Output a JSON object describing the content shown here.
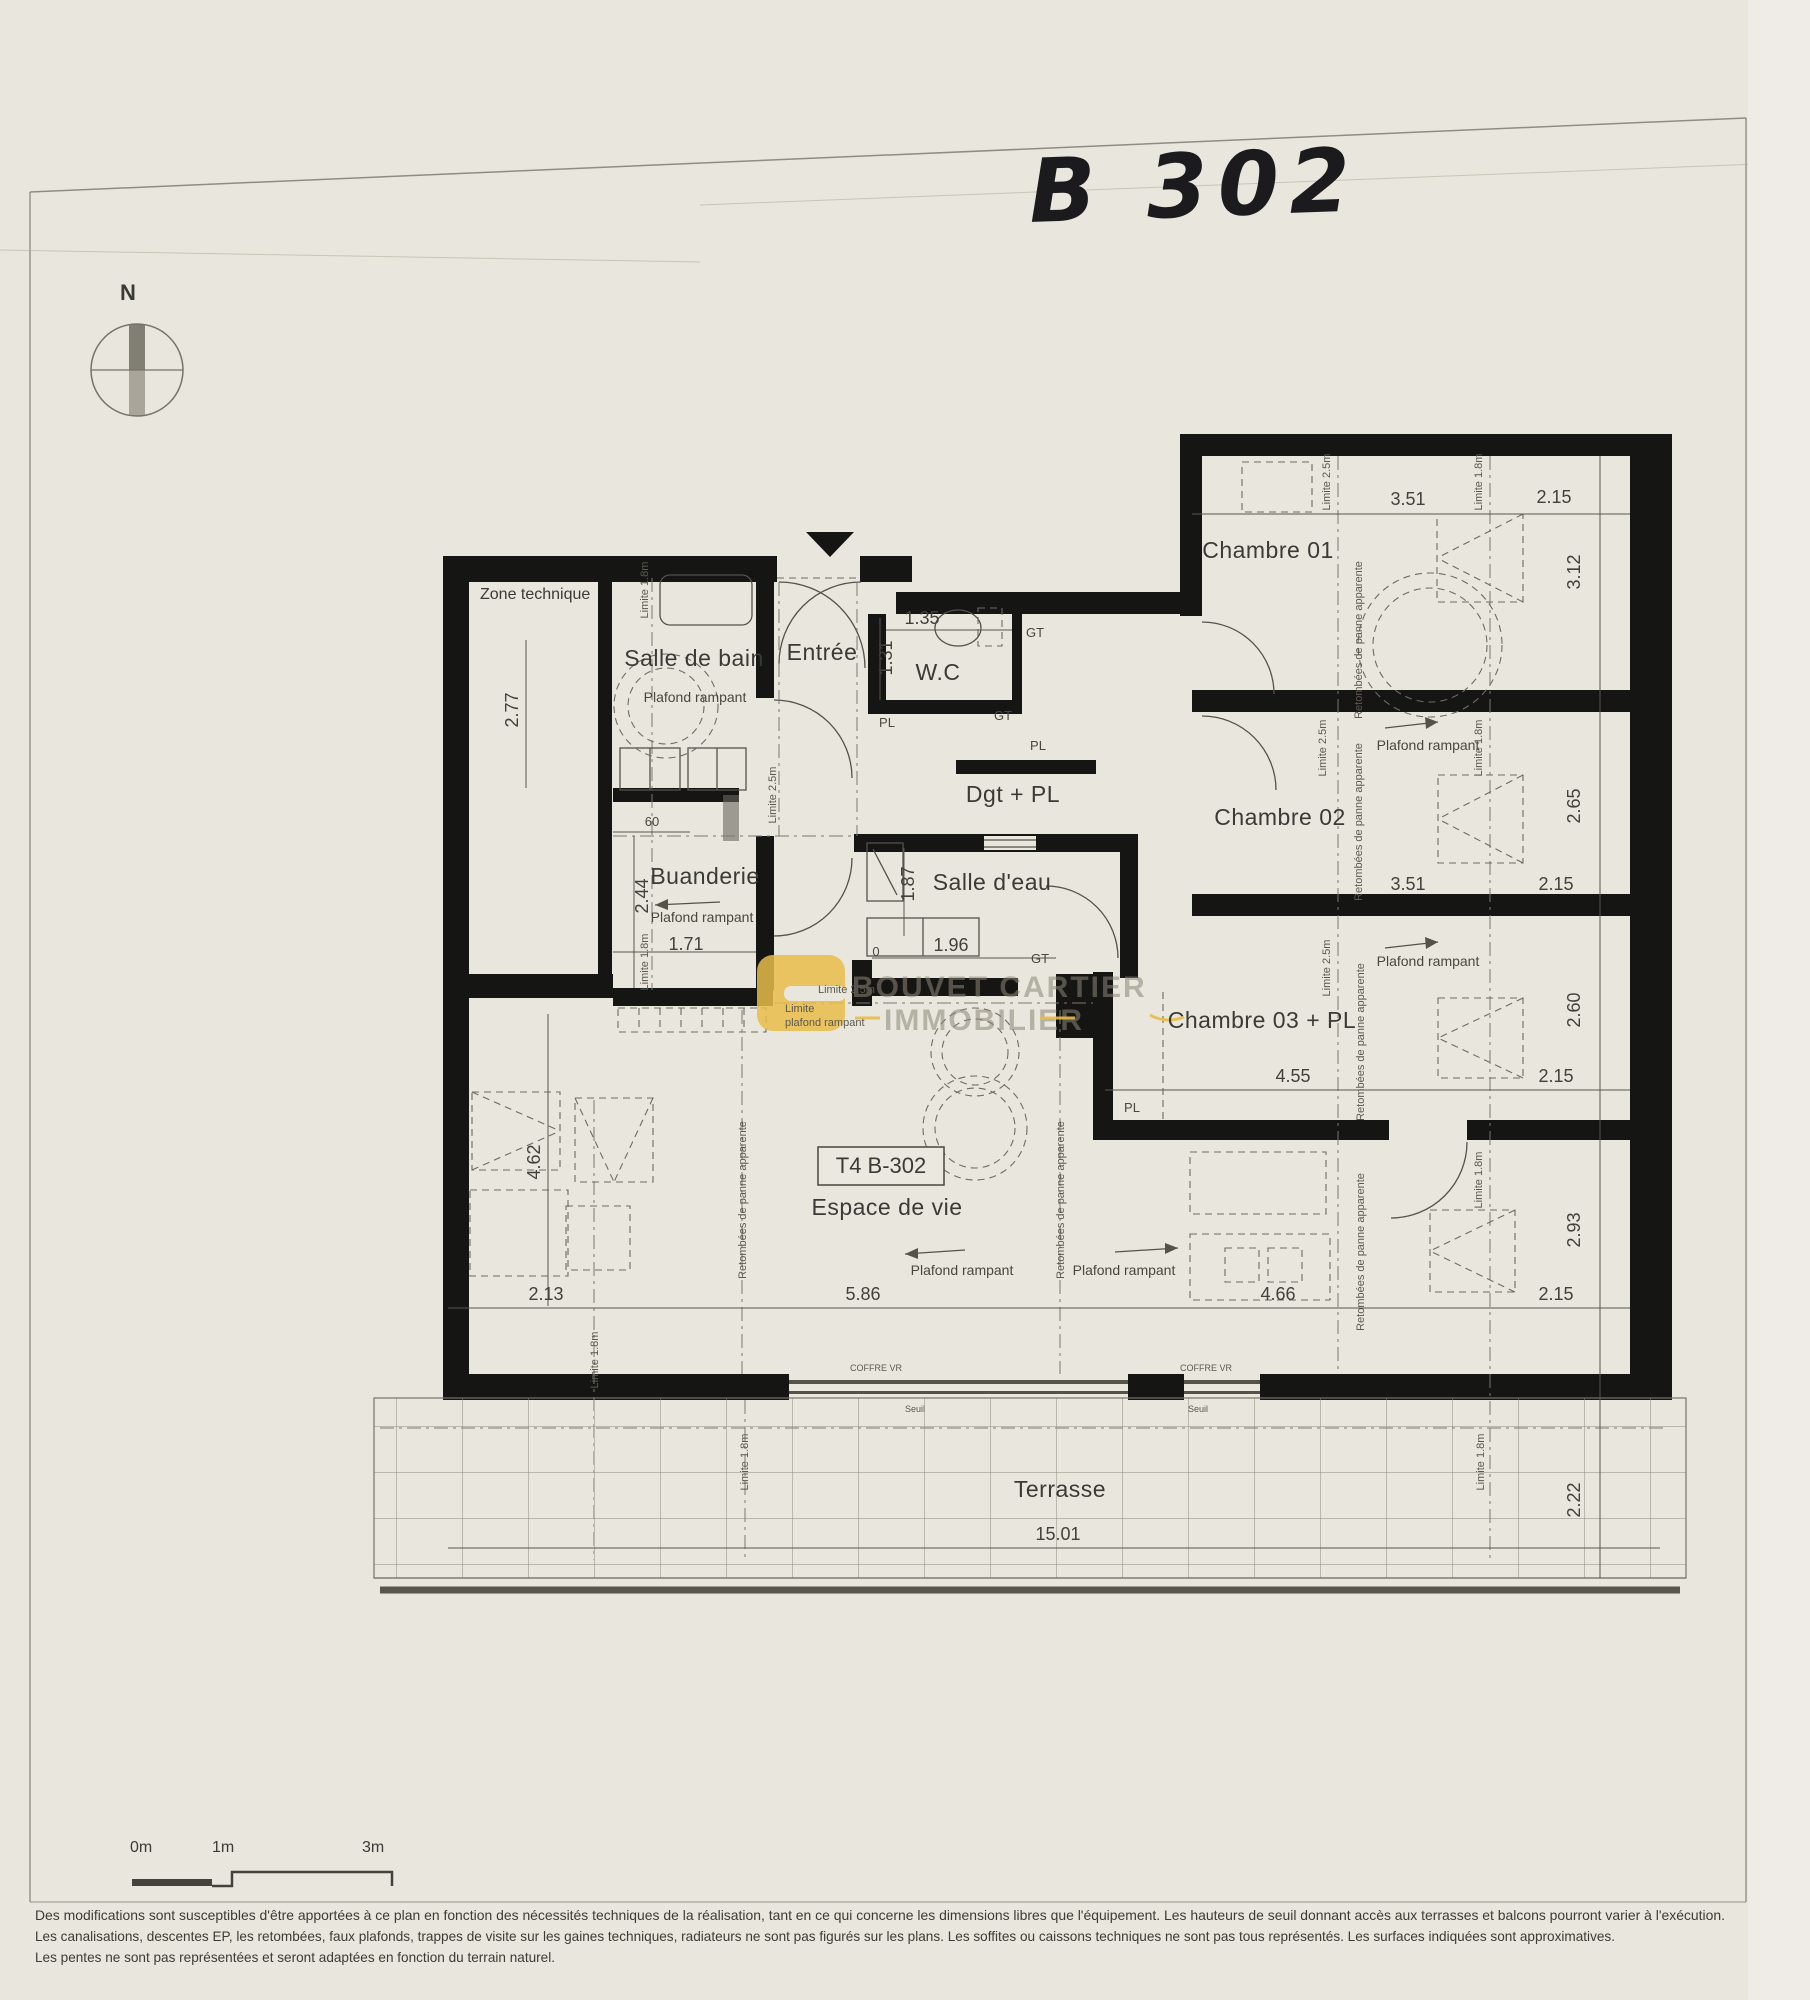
{
  "page": {
    "title_handwritten": "B 302",
    "compass_n": "N"
  },
  "rooms": {
    "zone_technique": "Zone technique",
    "salle_de_bain": "Salle de bain",
    "entree": "Entrée",
    "wc": "W.C",
    "dgt_pl": "Dgt + PL",
    "chambre01": "Chambre 01",
    "chambre02": "Chambre 02",
    "buanderie": "Buanderie",
    "salle_deau": "Salle d'eau",
    "chambre03": "Chambre 03 + PL",
    "espace_de_vie": "Espace de vie",
    "terrasse": "Terrasse",
    "unit_box": "T4 B-302"
  },
  "annotations": {
    "plafond_rampant": "Plafond rampant",
    "limite_25m": "Limite 2.5m",
    "limite_18m": "Limite 1.8m",
    "limite_word": "Limite",
    "plafond_rampant_lc": "plafond rampant",
    "retombees": "Retombées de panne apparente",
    "gt": "GT",
    "pl": "PL",
    "coffre_vr": "COFFRE VR",
    "seuil": "Seuil"
  },
  "dims": {
    "d351": "3.51",
    "d215": "2.15",
    "d312": "3.12",
    "d265": "2.65",
    "d260": "2.60",
    "d293": "2.93",
    "d222": "2.22",
    "d455": "4.55",
    "d466": "4.66",
    "d586": "5.86",
    "d213": "2.13",
    "d462": "4.62",
    "d277": "2.77",
    "d244": "2.44",
    "d171": "1.71",
    "d60": "60",
    "d135": "1.35",
    "d131": "1.31",
    "d187": "1.87",
    "d196": "1.96",
    "d0": "0",
    "d1501": "15.01"
  },
  "watermark": {
    "line1": "BOUVET CARTIER",
    "line2": "IMMOBILIER",
    "accent": "#e7bc49"
  },
  "scalebar": {
    "m0": "0m",
    "m1": "1m",
    "m3": "3m"
  },
  "disclaimer": {
    "line1": "Des modifications sont susceptibles d'être apportées à ce plan en fonction des nécessités techniques de la réalisation, tant en ce qui concerne les dimensions libres que l'équipement. Les hauteurs de seuil donnant accès aux terrasses et balcons pourront varier à l'exécution.",
    "line2": "Les canalisations, descentes EP, les retombées, faux plafonds, trappes de visite sur les gaines techniques, radiateurs ne sont pas figurés sur les plans. Les soffites ou caissons techniques ne sont pas tous représentés. Les surfaces indiquées sont approximatives.",
    "line3": "Les pentes ne sont pas représentées et seront adaptées en fonction du terrain naturel."
  }
}
